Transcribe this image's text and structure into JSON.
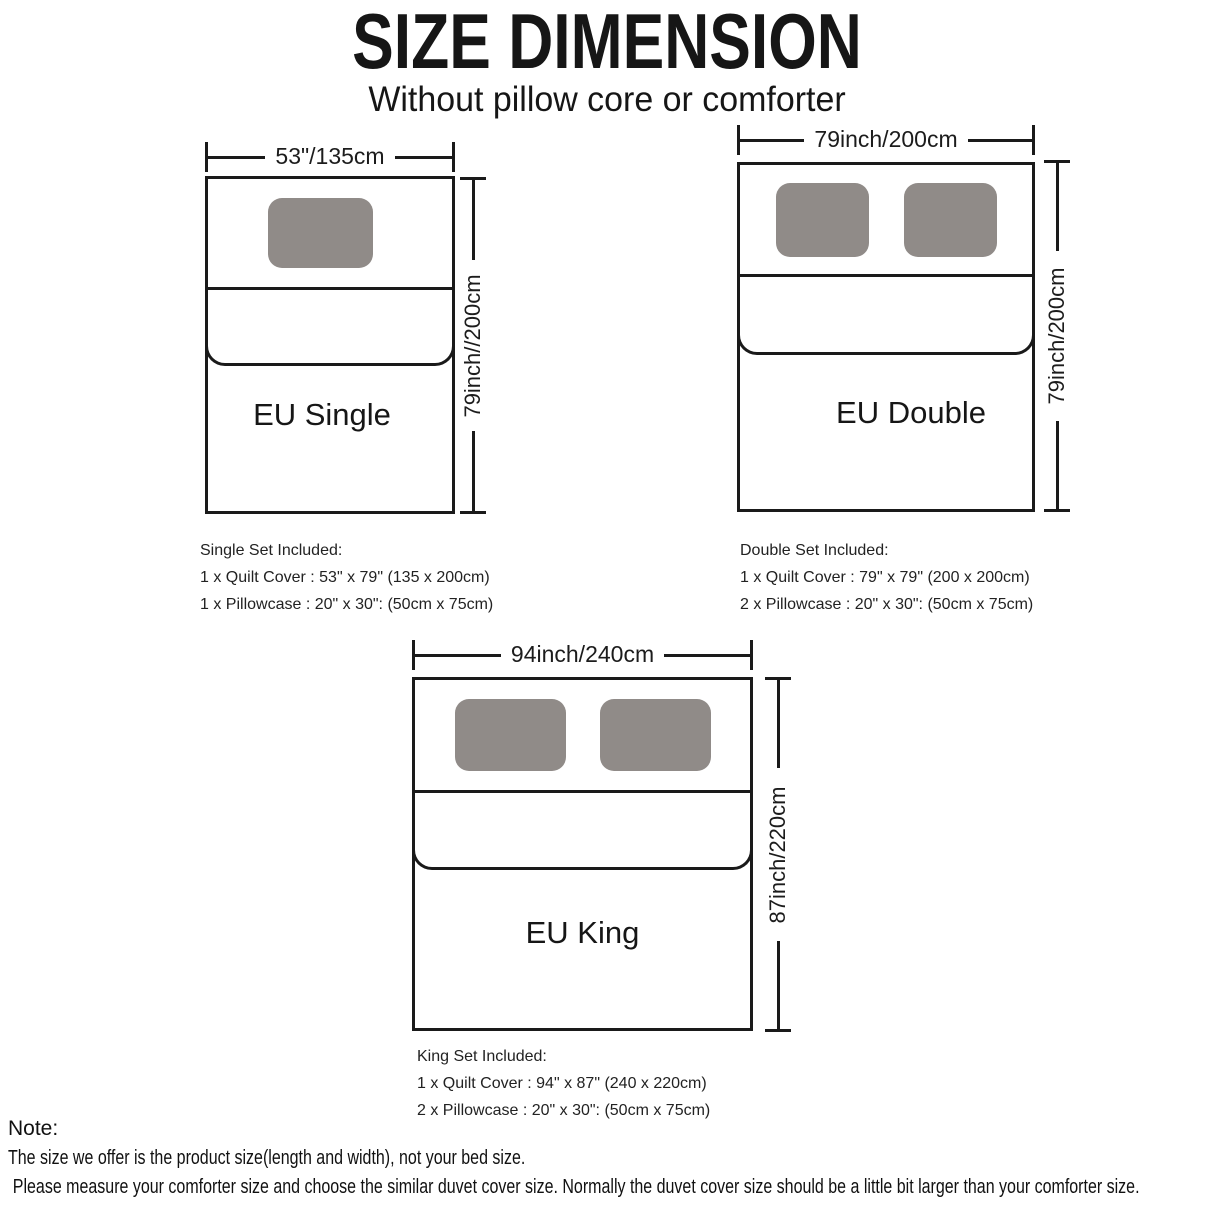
{
  "header": {
    "title": "SIZE DIMENSION",
    "subtitle": "Without pillow core or comforter"
  },
  "diagrams": [
    {
      "name": "EU Single",
      "width_label": "53\"/135cm",
      "height_label": "79inch//200cm",
      "pillows": 1,
      "set": {
        "title": "Single Set Included:",
        "lines": [
          "1 x Quilt Cover : 53\" x 79\" (135 x 200cm)",
          "1 x Pillowcase : 20\" x 30\": (50cm x 75cm)"
        ]
      }
    },
    {
      "name": "EU Double",
      "width_label": "79inch/200cm",
      "height_label": "79inch/200cm",
      "pillows": 2,
      "set": {
        "title": "Double Set Included:",
        "lines": [
          "1 x Quilt Cover : 79\" x 79\" (200 x 200cm)",
          "2 x Pillowcase : 20\" x 30\": (50cm x 75cm)"
        ]
      }
    },
    {
      "name": "EU King",
      "width_label": "94inch/240cm",
      "height_label": "87inch/220cm",
      "pillows": 2,
      "set": {
        "title": "King Set Included:",
        "lines": [
          "1 x Quilt Cover : 94\" x 87\" (240 x 220cm)",
          "2 x Pillowcase : 20\" x 30\": (50cm x 75cm)"
        ]
      }
    }
  ],
  "note": {
    "title": "Note:",
    "lines": [
      "The size we offer is the product size(length and width), not your bed size.",
      "Please measure your comforter size and choose the similar duvet cover size. Normally the duvet cover size should be a little bit larger than your comforter size."
    ]
  },
  "colors": {
    "line": "#1a1a1a",
    "pillow": "#908b88",
    "background": "#ffffff",
    "text": "#1c1c1c"
  }
}
